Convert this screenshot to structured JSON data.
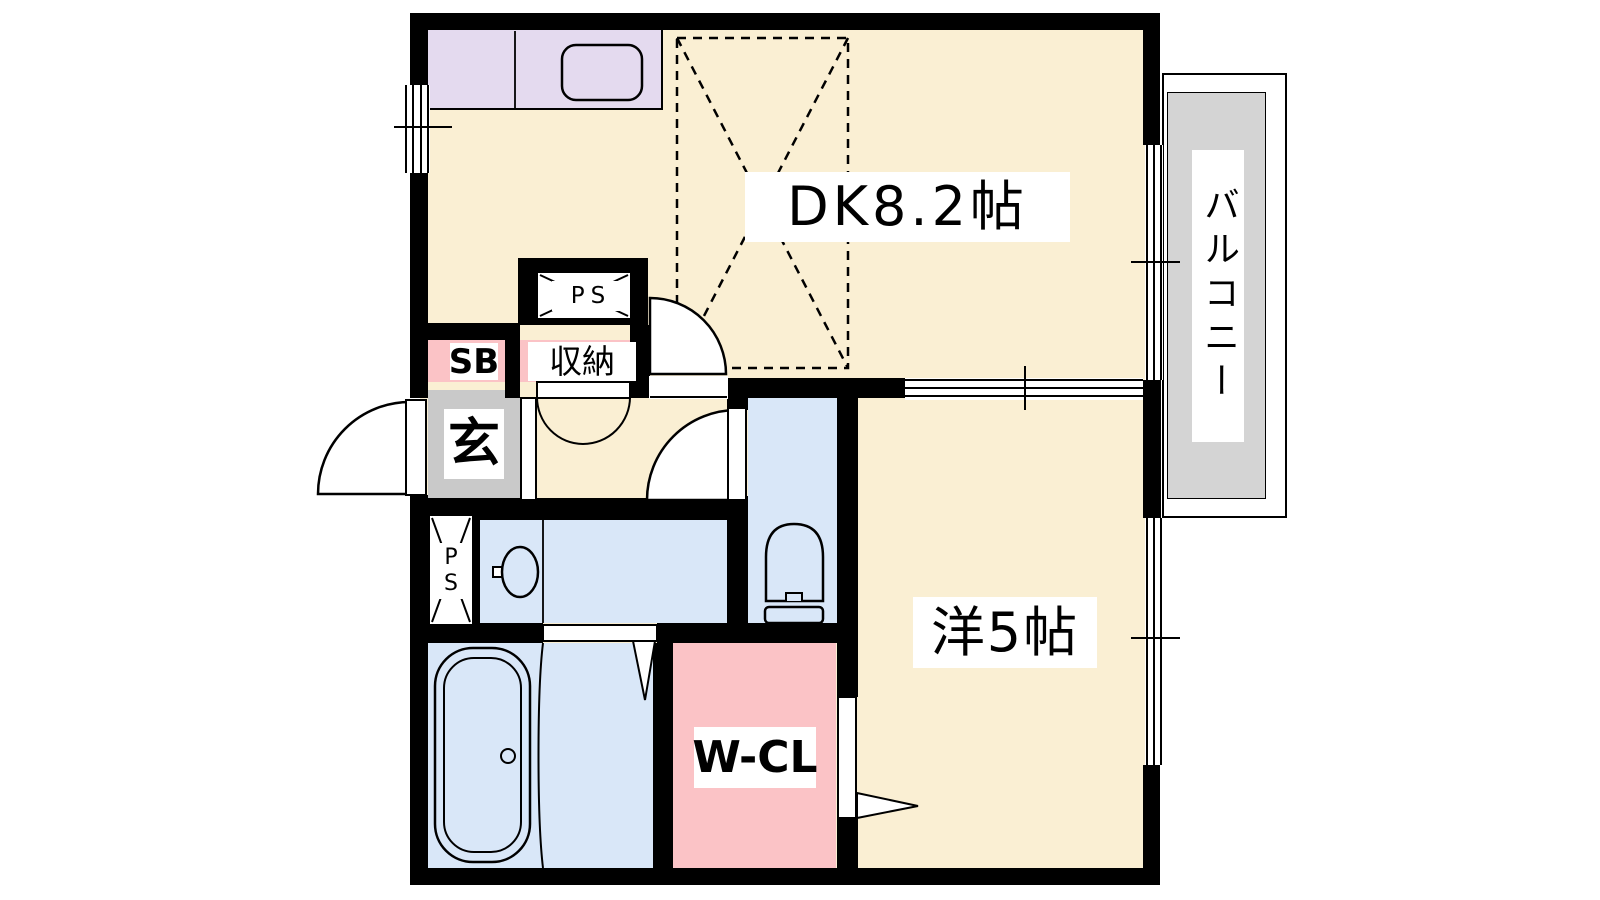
{
  "rooms": {
    "dining_kitchen": {
      "label": "DK8.2帖"
    },
    "western_room": {
      "label": "洋5帖"
    },
    "balcony": {
      "label": "バルコニー"
    },
    "walk_in_closet": {
      "label": "W-CL"
    },
    "entrance": {
      "label": "玄"
    },
    "shoe_box": {
      "label": "SB"
    },
    "storage": {
      "label": "収納"
    },
    "pipe_space_upper": {
      "label": "PS"
    },
    "pipe_space_lower": {
      "line1": "P",
      "line2": "S"
    }
  },
  "colors": {
    "room_floor_cream": "#FAEFD3",
    "wet_area_blue": "#D9E7F8",
    "kitchen_counter_lavender": "#E4DAEF",
    "closet_pink": "#FBC3C6",
    "entrance_gray": "#C9C9C9",
    "balcony_gray": "#D4D4D4",
    "wall_black": "#000000",
    "background_white": "#FFFFFF"
  }
}
